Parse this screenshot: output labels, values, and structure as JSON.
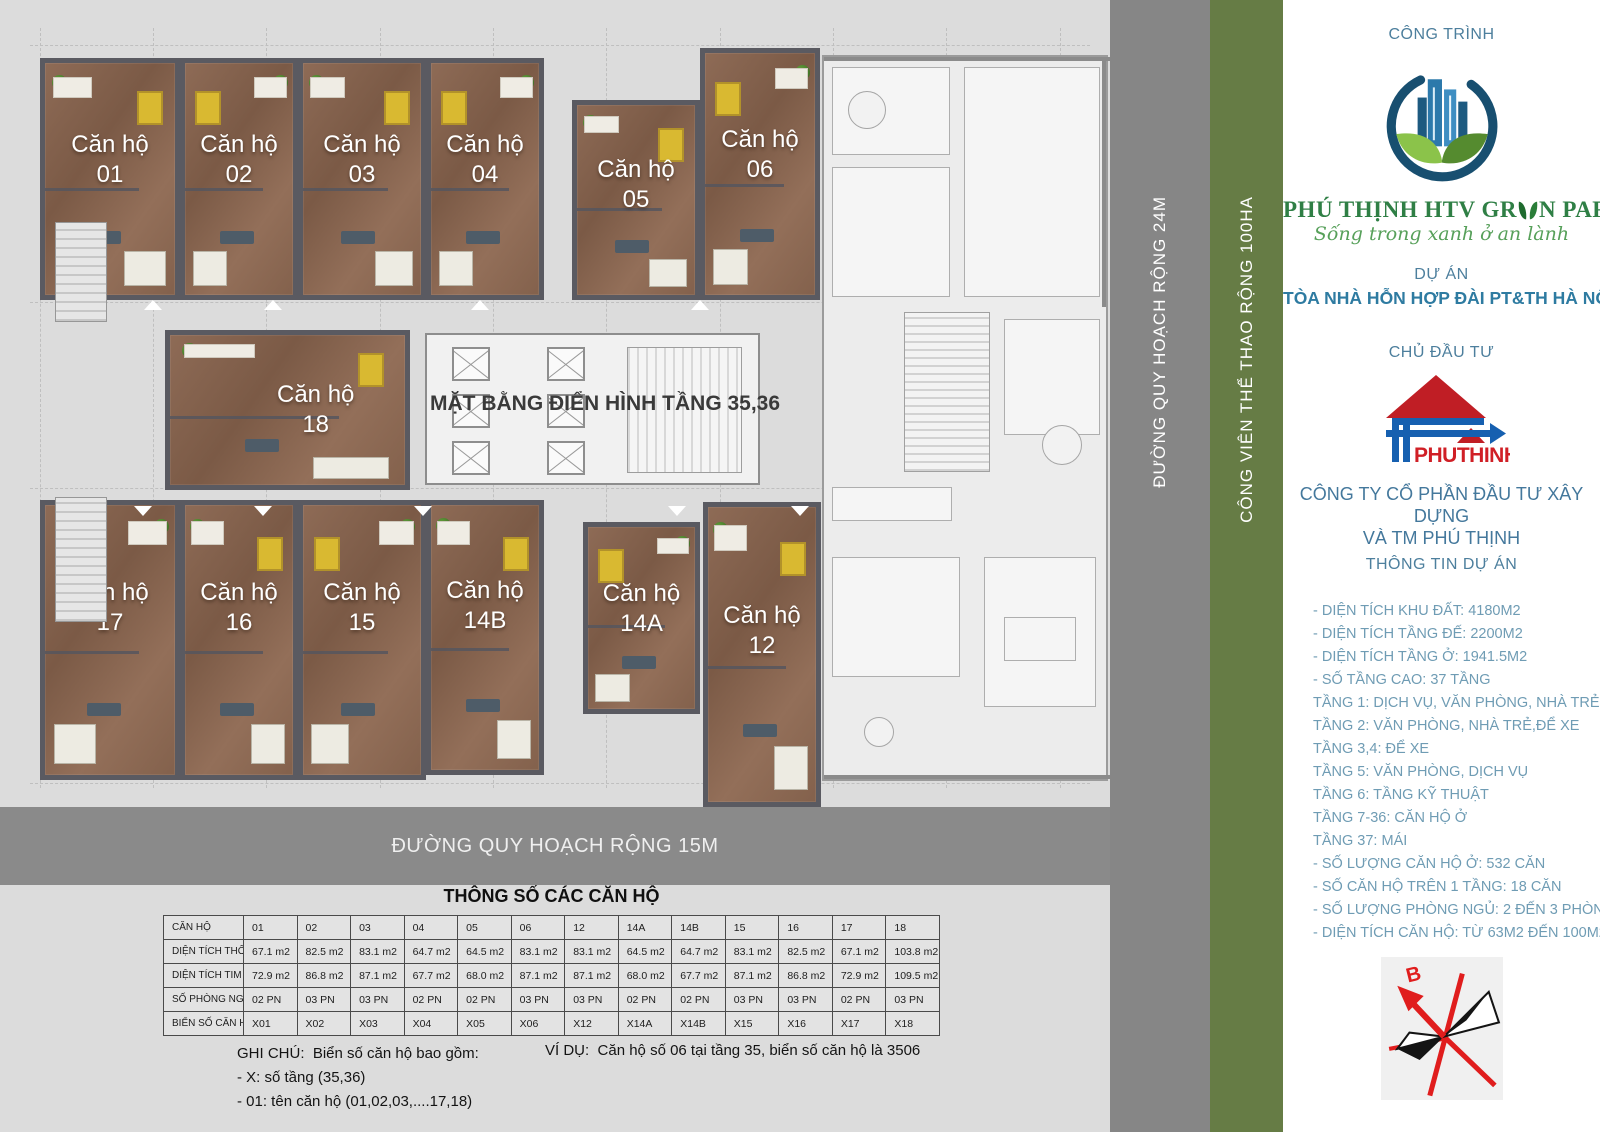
{
  "plan": {
    "title": "MẶT BẰNG ĐIỂN HÌNH TẦNG 35,36",
    "unit_prefix": "Căn hộ",
    "units": [
      "01",
      "02",
      "03",
      "04",
      "05",
      "06",
      "18",
      "17",
      "16",
      "15",
      "14B",
      "14A",
      "12"
    ]
  },
  "roads": {
    "bottom_road": "ĐƯỜNG QUY HOẠCH RỘNG 15M",
    "side_road": "ĐƯỜNG QUY HOẠCH RỘNG 24M",
    "park_strip": "CÔNG VIÊN THỂ THAO RỘNG 100HA"
  },
  "sidebar": {
    "construction_label": "CÔNG TRÌNH",
    "brand_name_pre": "PHÚ THỊNH HTV GR",
    "brand_name_post": "N PARK",
    "brand_tagline": "Sống trong xanh ở an lành",
    "project_label": "DỰ ÁN",
    "project_name": "TÒA NHÀ HỖN HỢP ĐÀI PT&TH HÀ NỘI",
    "investor_label": "CHỦ ĐẦU TƯ",
    "investor_logo_text": "PHUTHINH",
    "investor_name_line1": "CÔNG TY CỔ PHẦN ĐẦU TƯ XÂY DỰNG",
    "investor_name_line2": "VÀ TM PHÚ THỊNH",
    "info_label": "THÔNG TIN DỰ ÁN",
    "info_items": [
      "- DIỆN TÍCH KHU ĐẤT: 4180M2",
      "- DIỆN TÍCH TẦNG ĐẾ: 2200M2",
      "- DIỆN TÍCH TẦNG Ở: 1941.5M2",
      "- SỐ TẦNG CAO: 37 TẦNG",
      "TẦNG 1: DỊCH VỤ, VĂN PHÒNG, NHÀ TRẺ",
      "TẦNG 2: VĂN PHÒNG, NHÀ TRẺ,ĐỂ XE",
      "TẦNG 3,4: ĐỂ XE",
      "TẦNG 5: VĂN PHÒNG, DỊCH VỤ",
      "TẦNG 6: TẦNG KỸ THUẬT",
      "TẦNG 7-36: CĂN HỘ Ở",
      "TẦNG 37: MÁI",
      "- SỐ LƯỢNG CĂN HỘ Ở: 532 CĂN",
      "- SỐ CĂN HỘ TRÊN 1 TẦNG: 18 CĂN",
      "- SỐ LƯỢNG PHÒNG NGỦ: 2 ĐẾN 3 PHÒNG",
      "- DIỆN TÍCH CĂN HỘ: TỪ 63M2 ĐẾN 100M2"
    ],
    "compass_north_label": "B",
    "colors": {
      "accent_blue": "#44789c",
      "project_teal": "#2e7ba1",
      "brand_green": "#2f7f45",
      "strip_green": "#667c45",
      "road_gray": "#8a8a8a"
    }
  },
  "spec_table": {
    "title": "THÔNG SỐ CÁC CĂN HỘ",
    "rows": [
      {
        "label": "CĂN HỘ",
        "values": [
          "01",
          "02",
          "03",
          "04",
          "05",
          "06",
          "12",
          "14A",
          "14B",
          "15",
          "16",
          "17",
          "18"
        ]
      },
      {
        "label": "DIỆN TÍCH THÔNG THỦY",
        "values": [
          "67.1 m2",
          "82.5 m2",
          "83.1 m2",
          "64.7 m2",
          "64.5 m2",
          "83.1 m2",
          "83.1 m2",
          "64.5 m2",
          "64.7 m2",
          "83.1 m2",
          "82.5 m2",
          "67.1 m2",
          "103.8 m2"
        ]
      },
      {
        "label": "DIỆN TÍCH TIM TƯỜNG",
        "values": [
          "72.9 m2",
          "86.8 m2",
          "87.1 m2",
          "67.7 m2",
          "68.0 m2",
          "87.1 m2",
          "87.1 m2",
          "68.0 m2",
          "67.7 m2",
          "87.1 m2",
          "86.8 m2",
          "72.9 m2",
          "109.5 m2"
        ]
      },
      {
        "label": "SỐ PHÒNG NGỦ",
        "values": [
          "02 PN",
          "03 PN",
          "03 PN",
          "02 PN",
          "02 PN",
          "03 PN",
          "03 PN",
          "02 PN",
          "02 PN",
          "03 PN",
          "03 PN",
          "02 PN",
          "03 PN"
        ]
      },
      {
        "label": "BIỂN SỐ CĂN HỘ",
        "values": [
          "X01",
          "X02",
          "X03",
          "X04",
          "X05",
          "X06",
          "X12",
          "X14A",
          "X14B",
          "X15",
          "X16",
          "X17",
          "X18"
        ]
      }
    ]
  },
  "notes": {
    "ghi_chu_label": "GHI CHÚ:",
    "ghi_chu_intro": "Biển số căn hộ bao gồm:",
    "ghi_chu_lines": [
      "- X: số tầng (35,36)",
      "- 01: tên căn hộ (01,02,03,....17,18)"
    ],
    "vi_du_label": "VÍ DỤ:",
    "vi_du_text": "Căn hộ số 06 tại tầng 35, biển số căn hộ là 3506"
  }
}
